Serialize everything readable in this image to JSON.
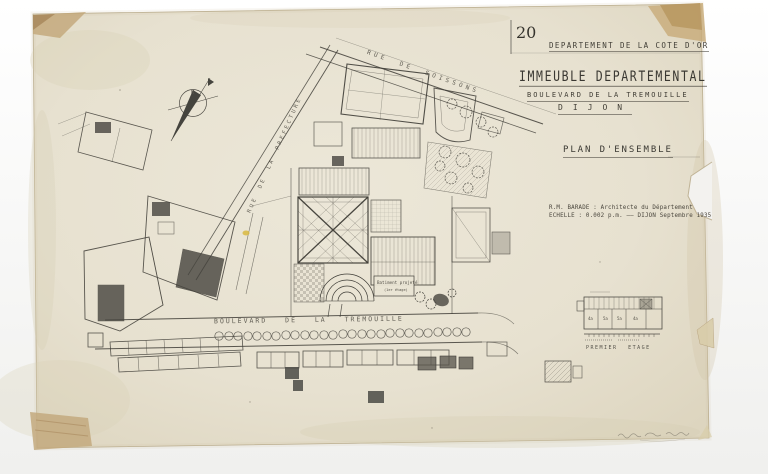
{
  "document": {
    "sheet_number": "20",
    "department": "DEPARTEMENT DE LA COTE D'OR",
    "title": "IMMEUBLE DEPARTEMENTAL",
    "subtitle": "BOULEVARD DE LA TREMOUILLE",
    "city": "DIJON",
    "plan_name": "PLAN D'ENSEMBLE",
    "architect_line": "R.M. BARADE : Architecte du Département",
    "scale_line": "ECHELLE : 0.002 p.m. —— DIJON Septembre 1935"
  },
  "streets": {
    "rue_soissons": "RUE DE SOISSONS",
    "rue_prefecture": "RUE DE LA PREFECTURE",
    "boulevard": "BOULEVARD DE LA TREMOUILLE"
  },
  "plan_labels": {
    "building_label": "Batiment projeté",
    "building_sublabel": "(1er étage)",
    "compass_n": "N"
  },
  "inset_plan": {
    "caption": "PREMIER ETAGE",
    "room_labels": [
      "4a",
      "5a",
      "5a",
      "4a"
    ]
  },
  "colors": {
    "paper": "#e9e3d2",
    "ink": "#3f3d36",
    "tape": "#c3a678",
    "background": "#f8f8f7",
    "highlight": "#d8b93f"
  }
}
